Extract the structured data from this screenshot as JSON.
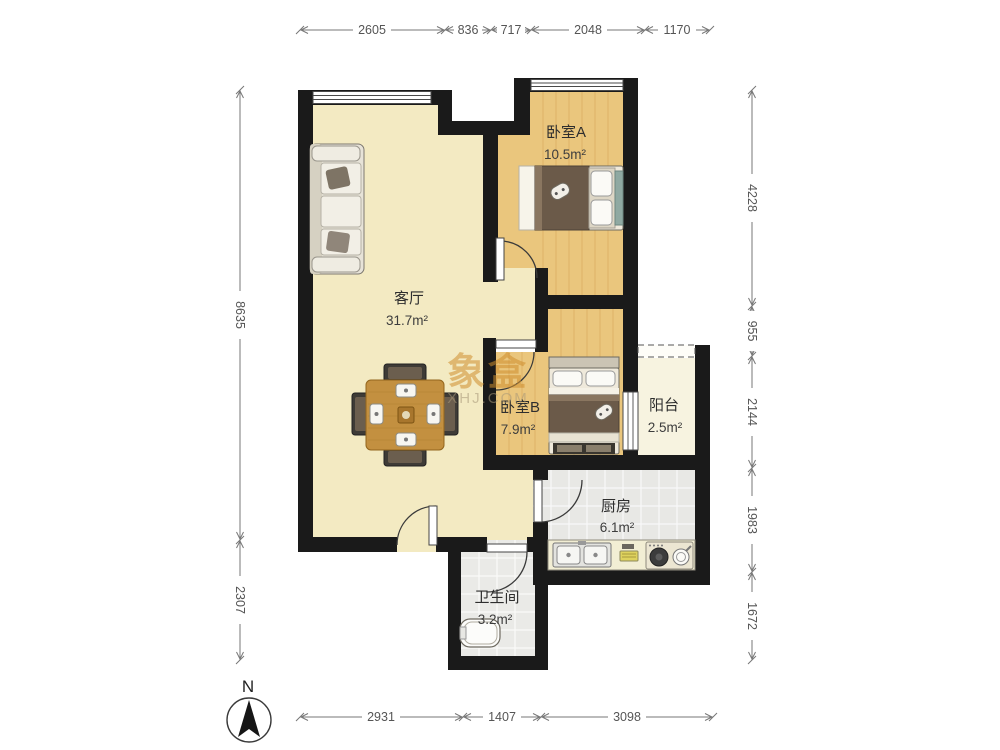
{
  "watermark": {
    "brand": "象盒",
    "site": "XHJ.COM"
  },
  "compass": {
    "north_label": "N"
  },
  "rooms": [
    {
      "name": "卧室A",
      "area": "10.5m²"
    },
    {
      "name": "客厅",
      "area": "31.7m²"
    },
    {
      "name": "卧室B",
      "area": "7.9m²"
    },
    {
      "name": "阳台",
      "area": "2.5m²"
    },
    {
      "name": "厨房",
      "area": "6.1m²"
    },
    {
      "name": "卫生间",
      "area": "3.2m²"
    }
  ],
  "dimensions_mm": {
    "top": [
      "2605",
      "836",
      "717",
      "2048",
      "1170"
    ],
    "bottom": [
      "2931",
      "1407",
      "3098"
    ],
    "left": [
      "8635",
      "2307"
    ],
    "right": [
      "4228",
      "955",
      "2144",
      "1983",
      "1672"
    ]
  },
  "colors": {
    "wall": "#1a1a1a",
    "living_floor": "#f3eac2",
    "bedroom_floor": "#eac67d",
    "tile_floor": "#e8e8e5",
    "balcony_floor": "#f7f3e0",
    "watermark_brand": "#cf8f2e",
    "dimension_text": "#555555"
  }
}
